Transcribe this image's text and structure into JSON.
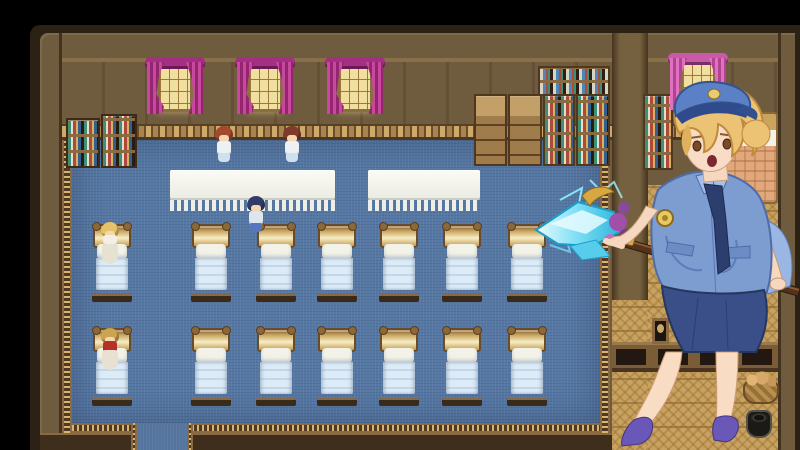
{
  "scene": {
    "description": "Top-down RPG interior: infirmary dormitory with two rows of seven beds on a blue carpet, magenta-curtained windows, medicine shelves and cabinets, nurse sprites, a side room with a peach bed and bread basket, and a large foreground portrait of a blonde policewoman holding a long spear tipped with a glowing ice crystal",
    "engine_style": "2D RPG map screenshot",
    "visible_text": "none"
  },
  "palette": {
    "letterbox": "#000000",
    "outer_frame": "#2c2115",
    "wall_wood": "#6f5b3e",
    "wall_panel_cream": "#e9e0ca",
    "wainscot": "#a8854e",
    "carpet_blue": "#5678a4",
    "carpet_border_gold": "#d8b470",
    "woven_floor": "#c8a260",
    "curtain_magenta": "#b0308e",
    "curtain_pink": "#d060b0",
    "bed_frame_gold": "#caa45c",
    "bed_blanket_blue": "#cfe0ef",
    "side_bed_blanket_peach": "#e2a87c",
    "ice_cyan": "#7adef5",
    "uniform_blue": "#7d9cd0",
    "skirt_navy": "#3a4e88",
    "heels_purple": "#6a58b8",
    "hair_blonde": "#ecc274"
  },
  "map": {
    "main_room": {
      "windows": {
        "y": 60,
        "xs": [
          147,
          237,
          327
        ],
        "curtain_color_name": "magenta"
      },
      "tables": [
        {
          "x": 170,
          "y": 170,
          "w": 165,
          "h": 30
        },
        {
          "x": 368,
          "y": 170,
          "w": 112,
          "h": 30
        }
      ],
      "bed_rows": [
        {
          "y": 224,
          "xs": [
            93,
            192,
            257,
            318,
            380,
            443,
            508
          ]
        },
        {
          "y": 328,
          "xs": [
            93,
            192,
            257,
            318,
            380,
            443,
            508
          ]
        }
      ],
      "bed_count": 14,
      "left_shelves": 2,
      "right_cabinets": 4,
      "door_gap": {
        "x": 137,
        "w": 50
      }
    },
    "side_room": {
      "bed_count": 1,
      "props": [
        "jar shelf",
        "pink curtain window",
        "peach blanket bed",
        "wall band with dark openings",
        "picture frame",
        "bread basket",
        "dark pot"
      ]
    },
    "sprites": [
      {
        "id": "nurse-auburn",
        "variant": "stand-front",
        "x": 214,
        "y": 126,
        "hair": "#a34a2c",
        "outfit": "#eef1f4",
        "accent": "#cfe0f0"
      },
      {
        "id": "nurse-maroon",
        "variant": "stand-front",
        "x": 282,
        "y": 126,
        "hair": "#7e3a2a",
        "outfit": "#eef1f4",
        "accent": "#cfe0f0"
      },
      {
        "id": "girl-navy-hair-back",
        "variant": "stand-back",
        "x": 246,
        "y": 196,
        "hair": "#323c6a",
        "outfit": "#dde6ee",
        "accent": "#5577c0"
      },
      {
        "id": "patient-blonde",
        "variant": "on-bed",
        "x": 100,
        "y": 222,
        "hair": "#e6c268",
        "outfit": "#f2f0e6",
        "accent": "#e6e2d2"
      },
      {
        "id": "patient-red-gown",
        "variant": "on-bed",
        "x": 100,
        "y": 328,
        "hair": "#caa44e",
        "outfit": "#b63028",
        "accent": "#e8e0d0"
      }
    ]
  },
  "portrait": {
    "character": "blonde woman in blue police uniform",
    "details": [
      "blue peaked cap with gold emblem",
      "short wavy blonde hair",
      "surprised open-mouth expression",
      "light blue short-sleeve shirt with pockets and gold badge",
      "navy necktie",
      "navy pencil skirt",
      "bare legs",
      "purple high heels",
      "long brown spear topped with glowing ice crystal and purple orbs"
    ]
  }
}
